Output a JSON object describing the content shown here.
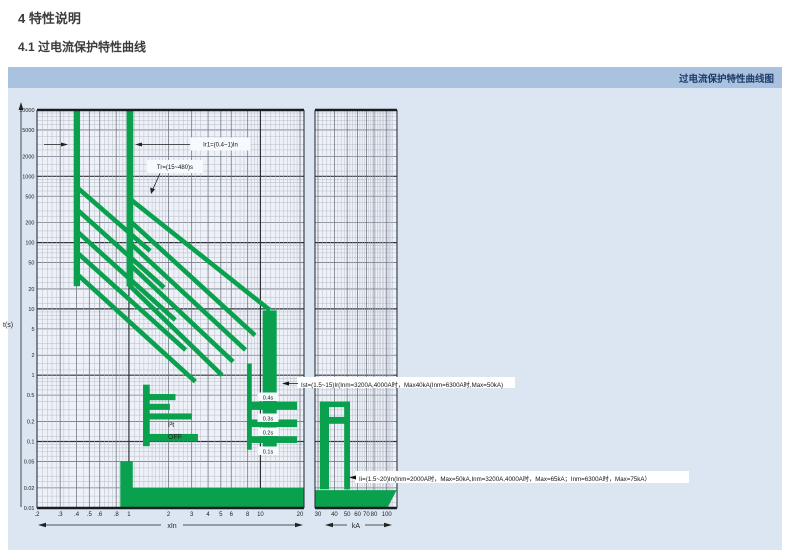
{
  "page": {
    "section_title": "4 特性说明",
    "subsection_title": "4.1 过电流保护特性曲线",
    "panel_header_title": "过电流保护特性曲线图"
  },
  "colors": {
    "curve_green": "#0aa14e",
    "panel_bg": "#dce6f3",
    "header_bg": "#a9c2e0",
    "header_text": "#1d3a66",
    "chart_bg": "#eef1f8",
    "label_box_bg": "#f6f9fd",
    "annotation_text": "#111111"
  },
  "chart_data": {
    "type": "line",
    "title": "过电流保护特性曲线图",
    "description": "断路器过电流保护特性曲线 (log-log 脱扣曲线)",
    "x_axis_left": {
      "label": "xIn",
      "scale": "log",
      "range": [
        0.2,
        20
      ],
      "ticks": [
        ".2",
        ".3",
        ".4",
        ".5",
        ".6",
        ".8",
        "1",
        "2",
        "3",
        "4",
        "5",
        "6",
        "8",
        "10",
        "20"
      ],
      "tick_values": [
        0.2,
        0.3,
        0.4,
        0.5,
        0.6,
        0.8,
        1,
        2,
        3,
        4,
        5,
        6,
        8,
        10,
        20
      ]
    },
    "x_axis_right": {
      "label": "kA",
      "scale": "log",
      "range": [
        30,
        100
      ],
      "ticks": [
        "30",
        "40",
        "50",
        "60",
        "70",
        "80",
        "100"
      ],
      "tick_values": [
        30,
        40,
        50,
        60,
        70,
        80,
        100
      ]
    },
    "y_axis": {
      "label": "t(s)",
      "scale": "log",
      "range": [
        0.01,
        10000
      ],
      "ticks": [
        "10000",
        "5000",
        "2000",
        "1000",
        "500",
        "200",
        "100",
        "50",
        "20",
        "10",
        "5",
        "2",
        "1",
        "0.5",
        "0.2",
        "0.1",
        "0.05",
        "0.02",
        "0.01"
      ],
      "tick_values": [
        10000,
        5000,
        2000,
        1000,
        500,
        200,
        100,
        50,
        20,
        10,
        5,
        2,
        1,
        0.5,
        0.2,
        0.1,
        0.05,
        0.02,
        0.01
      ]
    },
    "annotations": {
      "long_delay_pickup": "Ir1=(0.4~1)In",
      "long_delay_time": "Tr=(15~480)s",
      "short_delay": "Ist=(1.5~15)Ir(Inm=3200A,4000A时，Max40kA(Inm=6300A时,Max=50kA)",
      "instantaneous": "Ii=(1.5~20)In(Inm=2000A时，Max=50kA,Inm=3200A,4000A时，Max=65kA；Inm=6300A时，Max=75kA）",
      "i2t_off_line1": "I²t",
      "i2t_off_line2": "OFF",
      "step_time_labels": [
        "0.4s",
        "0.3s",
        "0.2s",
        "0.1s"
      ]
    },
    "elements": {
      "pickup_bands": [
        {
          "x": [
            0.38,
            0.425
          ],
          "t": [
            10000,
            22
          ]
        },
        {
          "x": [
            0.96,
            1.08
          ],
          "t": [
            10000,
            22
          ]
        }
      ],
      "inverse_time_lines_04In": [
        [
          0.4,
          690,
          1.45,
          75
        ],
        [
          0.4,
          320,
          1.85,
          21
        ],
        [
          0.4,
          150,
          2.25,
          6.8
        ],
        [
          0.4,
          72,
          2.7,
          2.4
        ],
        [
          0.4,
          34,
          3.2,
          0.8
        ]
      ],
      "inverse_time_lines_1In": [
        [
          1.0,
          470,
          11.8,
          9.6
        ],
        [
          1.0,
          220,
          9.1,
          4.0
        ],
        [
          1.0,
          102,
          7.7,
          2.4
        ],
        [
          1.0,
          48,
          6.2,
          1.6
        ],
        [
          1.0,
          23,
          5.1,
          1.0
        ]
      ],
      "short_delay_left": {
        "vertical": {
          "x": [
            1.28,
            1.44
          ],
          "t": [
            0.72,
            0.085
          ]
        },
        "arms": [
          {
            "x": [
              1.28,
              2.26
            ],
            "t": [
              0.52,
              0.42
            ]
          },
          {
            "x": [
              1.28,
              2.05
            ],
            "t": [
              0.37,
              0.3
            ]
          },
          {
            "x": [
              1.28,
              3.0
            ],
            "t": [
              0.265,
              0.215
            ]
          },
          {
            "x": [
              1.28,
              3.35
            ],
            "t": [
              0.13,
              0.1
            ]
          }
        ]
      },
      "short_delay_right": {
        "thin_vertical": {
          "x": [
            7.9,
            8.6
          ],
          "t": [
            1.5,
            0.075
          ]
        },
        "band": {
          "x": [
            10.4,
            13.3
          ],
          "t": [
            9.5,
            0.075
          ]
        },
        "bars": [
          {
            "x": [
              7.9,
              19.0
            ],
            "t": [
              0.4,
              0.3
            ]
          },
          {
            "x": [
              7.9,
              19.0
            ],
            "t": [
              0.215,
              0.165
            ]
          },
          {
            "x": [
              7.9,
              19.0
            ],
            "t": [
              0.12,
              0.095
            ]
          }
        ]
      },
      "instantaneous_block": {
        "x": [
          0.86,
          21.8
        ],
        "t": [
          0.02,
          0.0093
        ],
        "notch": {
          "x": [
            0.86,
            1.07
          ],
          "t": [
            0.05,
            0.02
          ]
        }
      },
      "ka_structure": {
        "band": {
          "kA": [
            31,
            36.4
          ],
          "t": [
            0.4,
            0.019
          ]
        },
        "arms": [
          {
            "kA": [
              31,
              52.5
            ],
            "t": [
              0.4,
              0.33
            ]
          },
          {
            "kA": [
              31,
              50.0
            ],
            "t": [
              0.235,
              0.185
            ]
          }
        ],
        "vertical": {
          "kA": [
            47.5,
            52.5
          ],
          "t": [
            0.4,
            0.019
          ]
        },
        "block": {
          "kA_top": [
            28.5,
            119
          ],
          "kA_bottom": [
            28.5,
            101
          ],
          "t_top": 0.0185
        }
      }
    }
  }
}
